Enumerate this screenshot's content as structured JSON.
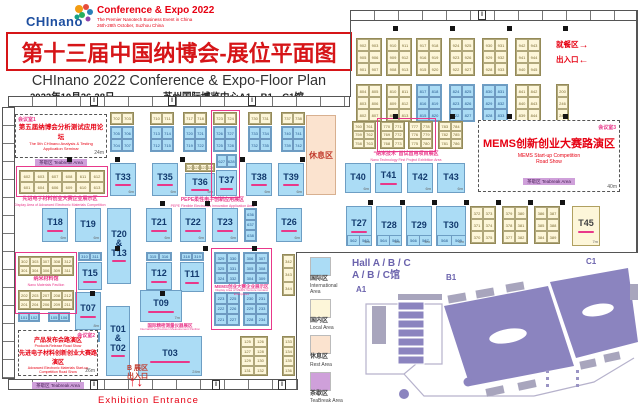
{
  "header": {
    "logo_text": "CHInano",
    "tagline1": "Conference & Expo 2022",
    "tagline2": "The Premier Nanotech Business Event in China",
    "tagline3": "26th-28th October, Suzhou China",
    "title_cn": "第十三届中国纳博会-展位平面图",
    "title_en": "CHInano 2022 Conference & Expo-Floor Plan",
    "date": "2022年10月26-28日",
    "venue": "苏州国际博览中心A1、B1、C1馆"
  },
  "entr": {
    "dining": "就餐区",
    "exit": "出入口",
    "right_arrow": "→",
    "left_arrow": "←",
    "b_zone": "B 展区",
    "b_exit": "出入口",
    "up": "↑",
    "down": "↓",
    "label": "Exhibition Entrance"
  },
  "rest": "休息区",
  "mr": {
    "mr1": {
      "tag": "会议室1",
      "cn": "第五届纳博会分析测试应用论坛",
      "en1": "The 5th CHInano Analysis & Testing",
      "en2": "Application Seminar",
      "chip": "茶歇区 Teabreak Area",
      "dim": "24m"
    },
    "mr2": {
      "tag": "会议室2",
      "cn1": "产品发布会路演区",
      "en1": "Products Release Road Show",
      "cn2": "先进电子材料创新创业大赛路演区",
      "en2": "Advanced Electronic Materials Start-up Competition Road Show",
      "chip": "茶歇区 Teabreak Area",
      "dim": "26m"
    },
    "mr3": {
      "tag": "会议室3",
      "cn": "MEMS创新创业大赛路演区",
      "en1": "MEMS Start-up Competition",
      "en2": "Road Show",
      "chip": "茶歇区 Teabreak Area",
      "dim": "40m"
    }
  },
  "zones": {
    "adv": {
      "cn": "先进电子材料创业大赛企业展示区",
      "en": "Display Area of Advanced Electronic Materials Competition"
    },
    "nano_first": {
      "cn": "“纳米技术”首试首用项目展区",
      "en": "Nano Technology First Project Exhibition Area"
    },
    "pepe": {
      "cn": "PEPE柔性电子创新应用展区",
      "en": "PEPE Flexible Electronics Innovation Application Area"
    },
    "mems": {
      "cn": "MEMS创业大赛企业展示区",
      "en": "Display Area of MEMS Venture Contest Enterprises"
    },
    "pavilion": {
      "cn": "纳米材料馆",
      "en": "Nano Materials Pavilion"
    },
    "precision": {
      "cn": "国际精密测量仪器展区",
      "en": "International Precision Measurement Pavilion"
    }
  },
  "legend": {
    "title_en": "Hall A / B / C",
    "title_cn": "A / B / C馆",
    "items": [
      {
        "color": "#abdcf5",
        "cn": "国际区",
        "en": "International Area"
      },
      {
        "color": "#fdf6d9",
        "cn": "国内区",
        "en": "Local Area"
      },
      {
        "color": "#fbe3cf",
        "cn": "休息区",
        "en": "Rest Area"
      },
      {
        "color": "#cfa0da",
        "cn": "茶歇区",
        "en": "TeaBreak Area"
      }
    ],
    "map_labels": {
      "a1": "A1",
      "b1": "B1",
      "c1": "C1"
    }
  },
  "floor": {
    "blocks": [
      {
        "x": 356,
        "y": 38,
        "w": 26,
        "h": 38,
        "c": "y",
        "cells": [
          "902",
          "903",
          "905",
          "906",
          "901",
          "907"
        ]
      },
      {
        "x": 386,
        "y": 38,
        "w": 26,
        "h": 38,
        "c": "y",
        "cells": [
          "910",
          "911",
          "909",
          "912",
          "908",
          "913"
        ]
      },
      {
        "x": 416,
        "y": 38,
        "w": 26,
        "h": 38,
        "c": "y",
        "cells": [
          "917",
          "918",
          "916",
          "919",
          "915",
          "920"
        ]
      },
      {
        "x": 449,
        "y": 38,
        "w": 26,
        "h": 38,
        "c": "y",
        "cells": [
          "924",
          "925",
          "923",
          "926",
          "922",
          "927"
        ]
      },
      {
        "x": 482,
        "y": 38,
        "w": 26,
        "h": 38,
        "c": "y",
        "cells": [
          "930",
          "931",
          "929",
          "932",
          "928",
          "933"
        ]
      },
      {
        "x": 515,
        "y": 38,
        "w": 26,
        "h": 38,
        "c": "y",
        "cells": [
          "942",
          "943",
          "941",
          "944",
          "940",
          "945"
        ]
      },
      {
        "x": 356,
        "y": 84,
        "w": 26,
        "h": 38,
        "c": "y",
        "cells": [
          "804",
          "805",
          "803",
          "806",
          "802",
          "807"
        ]
      },
      {
        "x": 386,
        "y": 84,
        "w": 26,
        "h": 38,
        "c": "y",
        "cells": [
          "810",
          "811",
          "809",
          "812",
          "808",
          "813"
        ]
      },
      {
        "x": 416,
        "y": 84,
        "w": 26,
        "h": 38,
        "c": "b",
        "cells": [
          "817",
          "818",
          "816",
          "819",
          "815",
          "820"
        ]
      },
      {
        "x": 449,
        "y": 84,
        "w": 26,
        "h": 38,
        "c": "b",
        "cells": [
          "824",
          "825",
          "823",
          "826",
          "822",
          "827"
        ]
      },
      {
        "x": 482,
        "y": 84,
        "w": 26,
        "h": 38,
        "c": "b",
        "cells": [
          "830",
          "831",
          "829",
          "832",
          "828",
          "833"
        ]
      },
      {
        "x": 515,
        "y": 84,
        "w": 26,
        "h": 38,
        "c": "y",
        "cells": [
          "841",
          "842",
          "840",
          "843",
          "839",
          "844"
        ]
      },
      {
        "x": 556,
        "y": 84,
        "w": 13,
        "h": 38,
        "c": "y",
        "n": 1,
        "cells": [
          "200",
          "246",
          "248"
        ]
      },
      {
        "x": 352,
        "y": 121,
        "w": 24,
        "h": 28,
        "c": "y",
        "cells": [
          "760",
          "761",
          "759",
          "762",
          "758",
          "763"
        ]
      },
      {
        "x": 380,
        "y": 121,
        "w": 25,
        "h": 28,
        "c": "y",
        "cells": [
          "770",
          "771",
          "769",
          "772",
          "768",
          "773"
        ]
      },
      {
        "x": 408,
        "y": 121,
        "w": 25,
        "h": 28,
        "c": "y",
        "cells": [
          "777",
          "778",
          "776",
          "779",
          "775",
          "780"
        ]
      },
      {
        "x": 438,
        "y": 121,
        "w": 25,
        "h": 28,
        "c": "y",
        "cells": [
          "783",
          "784",
          "782",
          "785",
          "781",
          "786"
        ]
      },
      {
        "x": 110,
        "y": 112,
        "w": 24,
        "h": 13,
        "c": "y",
        "cells": [
          "702",
          "703"
        ]
      },
      {
        "x": 110,
        "y": 126,
        "w": 24,
        "h": 26,
        "c": "b",
        "cells": [
          "705",
          "706",
          "704",
          "707"
        ]
      },
      {
        "x": 150,
        "y": 112,
        "w": 24,
        "h": 13,
        "c": "y",
        "cells": [
          "710",
          "711"
        ]
      },
      {
        "x": 150,
        "y": 126,
        "w": 24,
        "h": 26,
        "c": "b",
        "cells": [
          "713",
          "714",
          "712",
          "715"
        ]
      },
      {
        "x": 183,
        "y": 112,
        "w": 24,
        "h": 13,
        "c": "y",
        "cells": [
          "717",
          "718"
        ]
      },
      {
        "x": 183,
        "y": 126,
        "w": 24,
        "h": 26,
        "c": "b",
        "cells": [
          "720",
          "721",
          "719",
          "722"
        ]
      },
      {
        "x": 213,
        "y": 112,
        "w": 24,
        "h": 13,
        "c": "y",
        "cells": [
          "723",
          "724"
        ]
      },
      {
        "x": 213,
        "y": 126,
        "w": 24,
        "h": 26,
        "c": "b",
        "cells": [
          "726",
          "727",
          "725",
          "728"
        ]
      },
      {
        "x": 216,
        "y": 154,
        "w": 21,
        "h": 14,
        "c": "b",
        "cells": [
          "627",
          "628"
        ]
      },
      {
        "x": 248,
        "y": 112,
        "w": 24,
        "h": 13,
        "c": "y",
        "cells": [
          "730",
          "731"
        ]
      },
      {
        "x": 248,
        "y": 126,
        "w": 24,
        "h": 26,
        "c": "b",
        "cells": [
          "733",
          "734",
          "732",
          "735"
        ]
      },
      {
        "x": 281,
        "y": 112,
        "w": 24,
        "h": 13,
        "c": "y",
        "cells": [
          "737",
          "738"
        ]
      },
      {
        "x": 281,
        "y": 126,
        "w": 24,
        "h": 26,
        "c": "b",
        "cells": [
          "740",
          "741",
          "739",
          "742"
        ]
      },
      {
        "x": 19,
        "y": 170,
        "w": 86,
        "h": 24,
        "c": "y",
        "n": 6,
        "cells": [
          "602",
          "603",
          "607",
          "608",
          "611",
          "612",
          "601",
          "604",
          "606",
          "609",
          "610",
          "613"
        ]
      },
      {
        "x": 185,
        "y": 163,
        "w": 30,
        "h": 9,
        "c": "y",
        "n": 4,
        "cells": [
          "620",
          "621",
          "623",
          "624"
        ]
      },
      {
        "x": 244,
        "y": 208,
        "w": 13,
        "h": 34,
        "c": "b",
        "n": 1,
        "cells": [
          "636",
          "637",
          "638"
        ]
      },
      {
        "x": 18,
        "y": 256,
        "w": 56,
        "h": 20,
        "c": "y",
        "n": 5,
        "cells": [
          "302",
          "303",
          "307",
          "308",
          "312",
          "301",
          "304",
          "306",
          "309",
          "311"
        ]
      },
      {
        "x": 18,
        "y": 290,
        "w": 56,
        "h": 20,
        "c": "y",
        "n": 5,
        "cells": [
          "202",
          "203",
          "207",
          "208",
          "212",
          "201",
          "204",
          "206",
          "209",
          "211"
        ]
      },
      {
        "x": 78,
        "y": 252,
        "w": 24,
        "h": 9,
        "c": "b",
        "cells": [
          "310",
          "311"
        ]
      },
      {
        "x": 146,
        "y": 252,
        "w": 26,
        "h": 9,
        "c": "b",
        "cells": [
          "315",
          "316"
        ]
      },
      {
        "x": 180,
        "y": 252,
        "w": 24,
        "h": 9,
        "c": "b",
        "cells": [
          "318",
          "319"
        ]
      },
      {
        "x": 214,
        "y": 252,
        "w": 26,
        "h": 32,
        "c": "b",
        "cells": [
          "329",
          "330",
          "325",
          "331",
          "324",
          "332"
        ]
      },
      {
        "x": 243,
        "y": 252,
        "w": 26,
        "h": 32,
        "c": "b",
        "cells": [
          "306",
          "307",
          "305",
          "308",
          "304",
          "309"
        ]
      },
      {
        "x": 214,
        "y": 292,
        "w": 26,
        "h": 34,
        "c": "b",
        "cells": [
          "223",
          "225",
          "222",
          "226",
          "221",
          "227"
        ]
      },
      {
        "x": 243,
        "y": 292,
        "w": 26,
        "h": 34,
        "c": "b",
        "cells": [
          "230",
          "231",
          "229",
          "233",
          "228",
          "234"
        ]
      },
      {
        "x": 282,
        "y": 254,
        "w": 13,
        "h": 42,
        "c": "y",
        "n": 1,
        "cells": [
          "342",
          "343",
          "344"
        ]
      },
      {
        "x": 282,
        "y": 336,
        "w": 13,
        "h": 40,
        "c": "y",
        "n": 1,
        "cells": [
          "133",
          "134",
          "135",
          "136"
        ]
      },
      {
        "x": 240,
        "y": 336,
        "w": 28,
        "h": 40,
        "c": "y",
        "cells": [
          "125",
          "126",
          "127",
          "128",
          "129",
          "130",
          "131",
          "132"
        ]
      },
      {
        "x": 18,
        "y": 312,
        "w": 22,
        "h": 10,
        "c": "b",
        "cells": [
          "101",
          "102"
        ]
      },
      {
        "x": 48,
        "y": 312,
        "w": 22,
        "h": 10,
        "c": "b",
        "cells": [
          "105",
          "106"
        ]
      },
      {
        "x": 76,
        "y": 332,
        "w": 24,
        "h": 10,
        "c": "b",
        "cells": [
          "210",
          "211"
        ]
      },
      {
        "x": 470,
        "y": 206,
        "w": 26,
        "h": 38,
        "c": "y",
        "cells": [
          "372",
          "373",
          "371",
          "374",
          "370",
          "375"
        ]
      },
      {
        "x": 502,
        "y": 206,
        "w": 26,
        "h": 38,
        "c": "y",
        "cells": [
          "379",
          "380",
          "378",
          "381",
          "377",
          "382"
        ]
      },
      {
        "x": 534,
        "y": 206,
        "w": 26,
        "h": 38,
        "c": "y",
        "cells": [
          "386",
          "387",
          "385",
          "388",
          "384",
          "389"
        ]
      }
    ],
    "tbooths": [
      {
        "x": 110,
        "y": 163,
        "w": 26,
        "h": 33,
        "l": "T33",
        "d": "6m",
        "m": 1
      },
      {
        "x": 152,
        "y": 163,
        "w": 26,
        "h": 33,
        "l": "T35",
        "d": "6m",
        "m": 1
      },
      {
        "x": 185,
        "y": 173,
        "w": 30,
        "h": 23,
        "l": "T36",
        "d": "6m",
        "m": 1
      },
      {
        "x": 216,
        "y": 170,
        "w": 21,
        "h": 26,
        "l": "T37",
        "m": 1
      },
      {
        "x": 246,
        "y": 163,
        "w": 26,
        "h": 33,
        "l": "T38",
        "d": "6m",
        "m": 1
      },
      {
        "x": 278,
        "y": 163,
        "w": 26,
        "h": 33,
        "l": "T39",
        "d": "6m",
        "m": 1
      },
      {
        "x": 345,
        "y": 163,
        "w": 26,
        "h": 30,
        "l": "T40",
        "d": "6m"
      },
      {
        "x": 375,
        "y": 163,
        "w": 27,
        "h": 30,
        "l": "T41",
        "m": 1
      },
      {
        "x": 407,
        "y": 163,
        "w": 26,
        "h": 30,
        "l": "T42",
        "d": "6m"
      },
      {
        "x": 437,
        "y": 163,
        "w": 28,
        "h": 30,
        "l": "T43",
        "d": "6m"
      },
      {
        "x": 42,
        "y": 208,
        "w": 26,
        "h": 34,
        "l": "T18",
        "d": "6m",
        "m": 1
      },
      {
        "x": 75,
        "y": 208,
        "w": 26,
        "h": 34,
        "l": "T19",
        "d": "6m"
      },
      {
        "x": 107,
        "y": 208,
        "w": 24,
        "h": 76,
        "l": "T20|&|T13",
        "m": 1
      },
      {
        "x": 146,
        "y": 208,
        "w": 26,
        "h": 34,
        "l": "T21",
        "d": "6m",
        "m": 1
      },
      {
        "x": 180,
        "y": 208,
        "w": 26,
        "h": 34,
        "l": "T22",
        "d": "6m",
        "m": 1
      },
      {
        "x": 212,
        "y": 208,
        "w": 26,
        "h": 34,
        "l": "T23",
        "d": "6m",
        "m": 1
      },
      {
        "x": 276,
        "y": 208,
        "w": 26,
        "h": 34,
        "l": "T26",
        "d": "6m",
        "m": 1
      },
      {
        "x": 346,
        "y": 206,
        "w": 26,
        "h": 40,
        "l": "T27",
        "d": "6m",
        "m": 1,
        "cells": [
          "562",
          "563"
        ]
      },
      {
        "x": 376,
        "y": 206,
        "w": 26,
        "h": 40,
        "l": "T28",
        "d": "6m",
        "cells": [
          "564",
          "565"
        ]
      },
      {
        "x": 406,
        "y": 206,
        "w": 26,
        "h": 40,
        "l": "T29",
        "d": "6m",
        "cells": [
          "566",
          "567"
        ]
      },
      {
        "x": 436,
        "y": 206,
        "w": 30,
        "h": 40,
        "l": "T30",
        "d": "6m",
        "cells": [
          "568",
          "569"
        ]
      },
      {
        "x": 572,
        "y": 206,
        "w": 28,
        "h": 40,
        "l": "T45",
        "c": "y",
        "d": "7m",
        "m": 1
      },
      {
        "x": 78,
        "y": 262,
        "w": 24,
        "h": 28,
        "l": "T15",
        "m": 1
      },
      {
        "x": 146,
        "y": 262,
        "w": 26,
        "h": 28,
        "l": "T12",
        "m": 1
      },
      {
        "x": 180,
        "y": 262,
        "w": 24,
        "h": 30,
        "l": "T11",
        "m": 1
      },
      {
        "x": 75,
        "y": 292,
        "w": 26,
        "h": 38,
        "l": "T07",
        "d": "8m",
        "m": 1
      },
      {
        "x": 140,
        "y": 290,
        "w": 42,
        "h": 32,
        "l": "T09",
        "d": "7m",
        "m": 1
      },
      {
        "x": 106,
        "y": 306,
        "w": 24,
        "h": 70,
        "l": "T01|&|T02",
        "m": 1
      },
      {
        "x": 138,
        "y": 336,
        "w": 64,
        "h": 40,
        "l": "T03",
        "d": "24m",
        "m": 1
      }
    ],
    "pillars": [
      [
        393,
        26
      ],
      [
        450,
        26
      ],
      [
        507,
        26
      ],
      [
        563,
        26
      ],
      [
        393,
        114
      ],
      [
        450,
        114
      ],
      [
        507,
        114
      ],
      [
        563,
        114
      ],
      [
        67,
        157
      ],
      [
        115,
        157
      ],
      [
        180,
        157
      ],
      [
        240,
        157
      ],
      [
        300,
        157
      ],
      [
        160,
        201
      ],
      [
        205,
        201
      ],
      [
        252,
        201
      ],
      [
        368,
        200
      ],
      [
        400,
        200
      ],
      [
        432,
        200
      ],
      [
        464,
        200
      ],
      [
        496,
        200
      ],
      [
        528,
        200
      ],
      [
        560,
        200
      ],
      [
        115,
        246
      ],
      [
        203,
        246
      ],
      [
        252,
        246
      ],
      [
        90,
        291
      ],
      [
        160,
        291
      ]
    ],
    "doors": [
      [
        90,
        96
      ],
      [
        168,
        96
      ],
      [
        248,
        96
      ],
      [
        478,
        10
      ],
      [
        90,
        380
      ],
      [
        212,
        380
      ],
      [
        278,
        380
      ]
    ]
  }
}
